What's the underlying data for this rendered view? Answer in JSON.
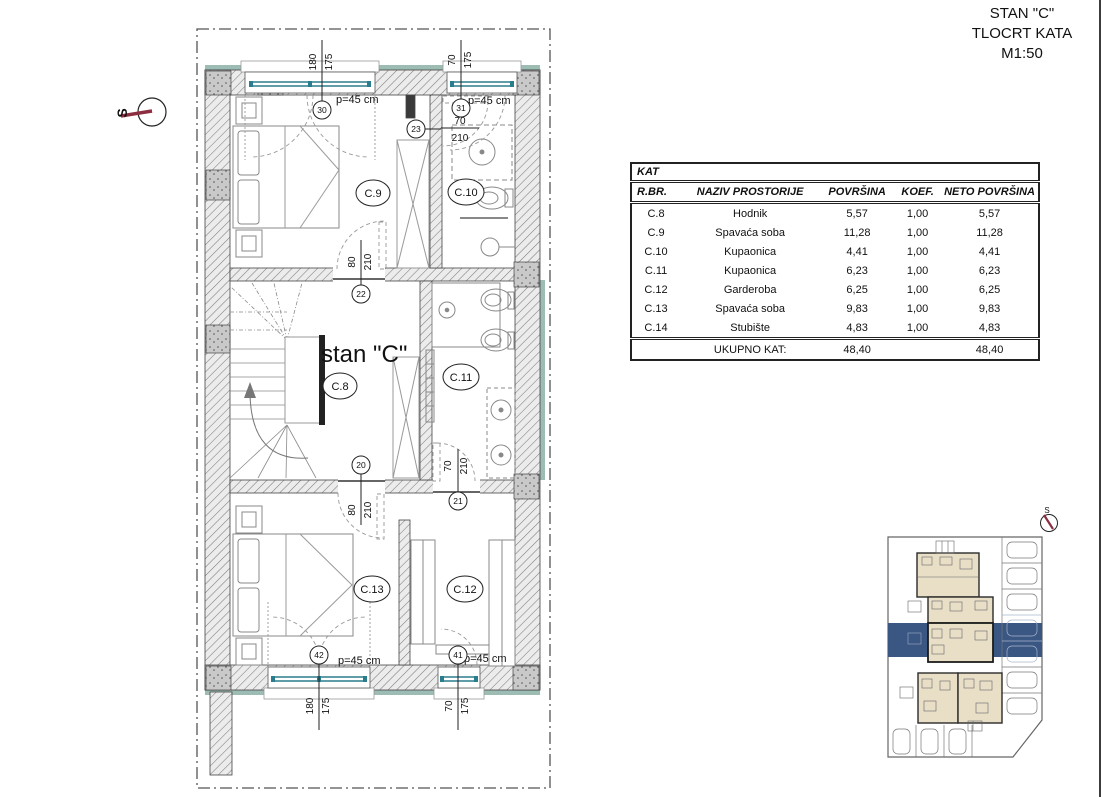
{
  "title_block": {
    "line1": "STAN \"C\"",
    "line2": "TLOCRT KATA",
    "line3": "M1:50"
  },
  "plan": {
    "apartment_label": "stan \"C\"",
    "compass_label": "S",
    "parapet": "p=45 cm",
    "rooms": {
      "c8": "C.8",
      "c9": "C.9",
      "c10": "C.10",
      "c11": "C.11",
      "c12": "C.12",
      "c13": "C.13"
    },
    "refs": {
      "w30": "30",
      "w31": "31",
      "w41": "41",
      "w42": "42",
      "d20": "20",
      "d21": "21",
      "d22": "22",
      "d23": "23"
    },
    "dims": {
      "top_w1": {
        "a": "180",
        "b": "175"
      },
      "top_w2": {
        "a": "70",
        "b": "175"
      },
      "bot_w1": {
        "a": "180",
        "b": "175"
      },
      "bot_w2": {
        "a": "70",
        "b": "175"
      },
      "door23": {
        "a": "70",
        "b": "210"
      },
      "door22": {
        "a": "80",
        "b": "210"
      },
      "door20": {
        "a": "80",
        "b": "210"
      },
      "door21": {
        "a": "70",
        "b": "210"
      }
    }
  },
  "site_plan": {
    "north_label": "S"
  },
  "table": {
    "title": "KAT",
    "columns": [
      "R.BR.",
      "NAZIV PROSTORIJE",
      "POVRŠINA",
      "KOEF.",
      "NETO POVRŠINA"
    ],
    "rows": [
      [
        "C.8",
        "Hodnik",
        "5,57",
        "1,00",
        "5,57"
      ],
      [
        "C.9",
        "Spavaća soba",
        "11,28",
        "1,00",
        "11,28"
      ],
      [
        "C.10",
        "Kupaonica",
        "4,41",
        "1,00",
        "4,41"
      ],
      [
        "C.11",
        "Kupaonica",
        "6,23",
        "1,00",
        "6,23"
      ],
      [
        "C.12",
        "Garderoba",
        "6,25",
        "1,00",
        "6,25"
      ],
      [
        "C.13",
        "Spavaća soba",
        "9,83",
        "1,00",
        "9,83"
      ],
      [
        "C.14",
        "Stubište",
        "4,83",
        "1,00",
        "4,83"
      ]
    ],
    "total": {
      "label": "UKUPNO KAT:",
      "povrsina": "48,40",
      "koef": "",
      "neto": "48,40"
    }
  },
  "colors": {
    "accent_blue": "#3a5682",
    "glass_teal": "#2a7d8c",
    "insulation_teal": "#9dbcb4",
    "compass_red": "#8b2e3f",
    "building_beige": "#e9dfc7"
  }
}
